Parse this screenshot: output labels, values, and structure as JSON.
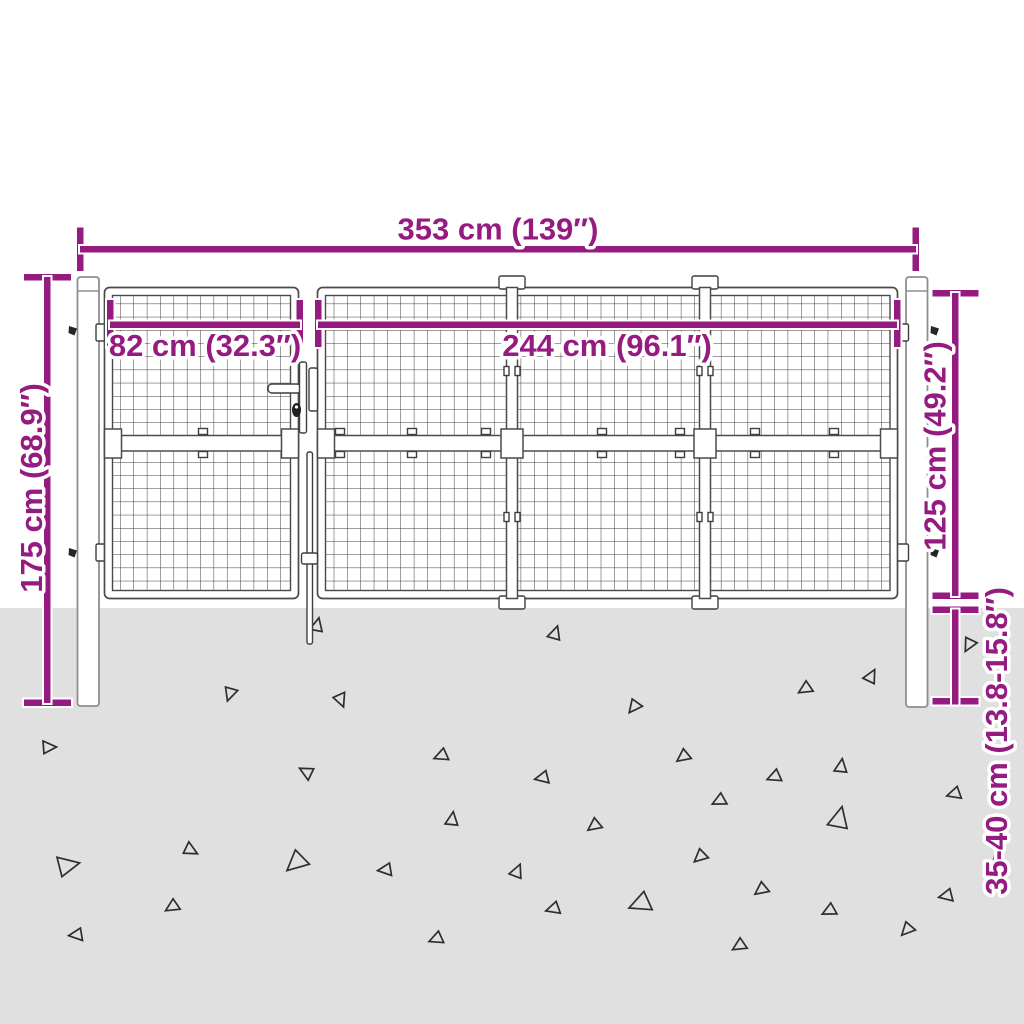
{
  "diagram": {
    "subject": "mesh-garden-gate-with-side-door-and-posts",
    "dims": {
      "total_width": {
        "cm": "353",
        "inch": "139",
        "label": "353 cm (139″)"
      },
      "side_gate_width": {
        "cm": "82",
        "inch": "32.3",
        "label": "82 cm (32.3″)"
      },
      "main_gate_width": {
        "cm": "244",
        "inch": "96.1",
        "label": "244 cm (96.1″)"
      },
      "post_height": {
        "cm": "175",
        "inch": "68.9",
        "label": "175 cm (68.9″)"
      },
      "mesh_height": {
        "cm": "125",
        "inch": "49.2",
        "label": "125 cm (49.2″)"
      },
      "underground_depth": {
        "cm": "35-40",
        "inch": "13.8-15.8",
        "label": "35-40 cm (13.8-15.8″)"
      }
    },
    "colors": {
      "accent": "#951b81",
      "ground": "#e0e0e0",
      "outline": "#3c3c3c",
      "background": "#ffffff"
    },
    "ground": {
      "triangles": [
        [
          230,
          694,
          12,
          200
        ],
        [
          341,
          700,
          12,
          160
        ],
        [
          49,
          747,
          12,
          90
        ],
        [
          441,
          756,
          12,
          250
        ],
        [
          306,
          772,
          12,
          300
        ],
        [
          452,
          819,
          12,
          10
        ],
        [
          191,
          850,
          12,
          120
        ],
        [
          296,
          863,
          19,
          230
        ],
        [
          385,
          870,
          12,
          265
        ],
        [
          68,
          865,
          19,
          80
        ],
        [
          172,
          907,
          12,
          240
        ],
        [
          76,
          935,
          12,
          265
        ],
        [
          436,
          939,
          12,
          250
        ],
        [
          317,
          625,
          12,
          15
        ],
        [
          555,
          633,
          12,
          20
        ],
        [
          871,
          676,
          12,
          30
        ],
        [
          805,
          689,
          12,
          240
        ],
        [
          634,
          707,
          12,
          220
        ],
        [
          683,
          757,
          12,
          235
        ],
        [
          542,
          778,
          12,
          260
        ],
        [
          774,
          777,
          12,
          250
        ],
        [
          841,
          766,
          12,
          10
        ],
        [
          719,
          801,
          12,
          245
        ],
        [
          954,
          794,
          12,
          255
        ],
        [
          594,
          826,
          12,
          235
        ],
        [
          839,
          818,
          19,
          15
        ],
        [
          700,
          857,
          12,
          230
        ],
        [
          517,
          871,
          12,
          25
        ],
        [
          997,
          861,
          12,
          220
        ],
        [
          761,
          890,
          12,
          235
        ],
        [
          553,
          909,
          12,
          255
        ],
        [
          640,
          904,
          19,
          250
        ],
        [
          829,
          911,
          12,
          245
        ],
        [
          946,
          896,
          12,
          260
        ],
        [
          907,
          930,
          12,
          225
        ],
        [
          739,
          946,
          12,
          240
        ],
        [
          969,
          645,
          12,
          210
        ]
      ]
    }
  }
}
